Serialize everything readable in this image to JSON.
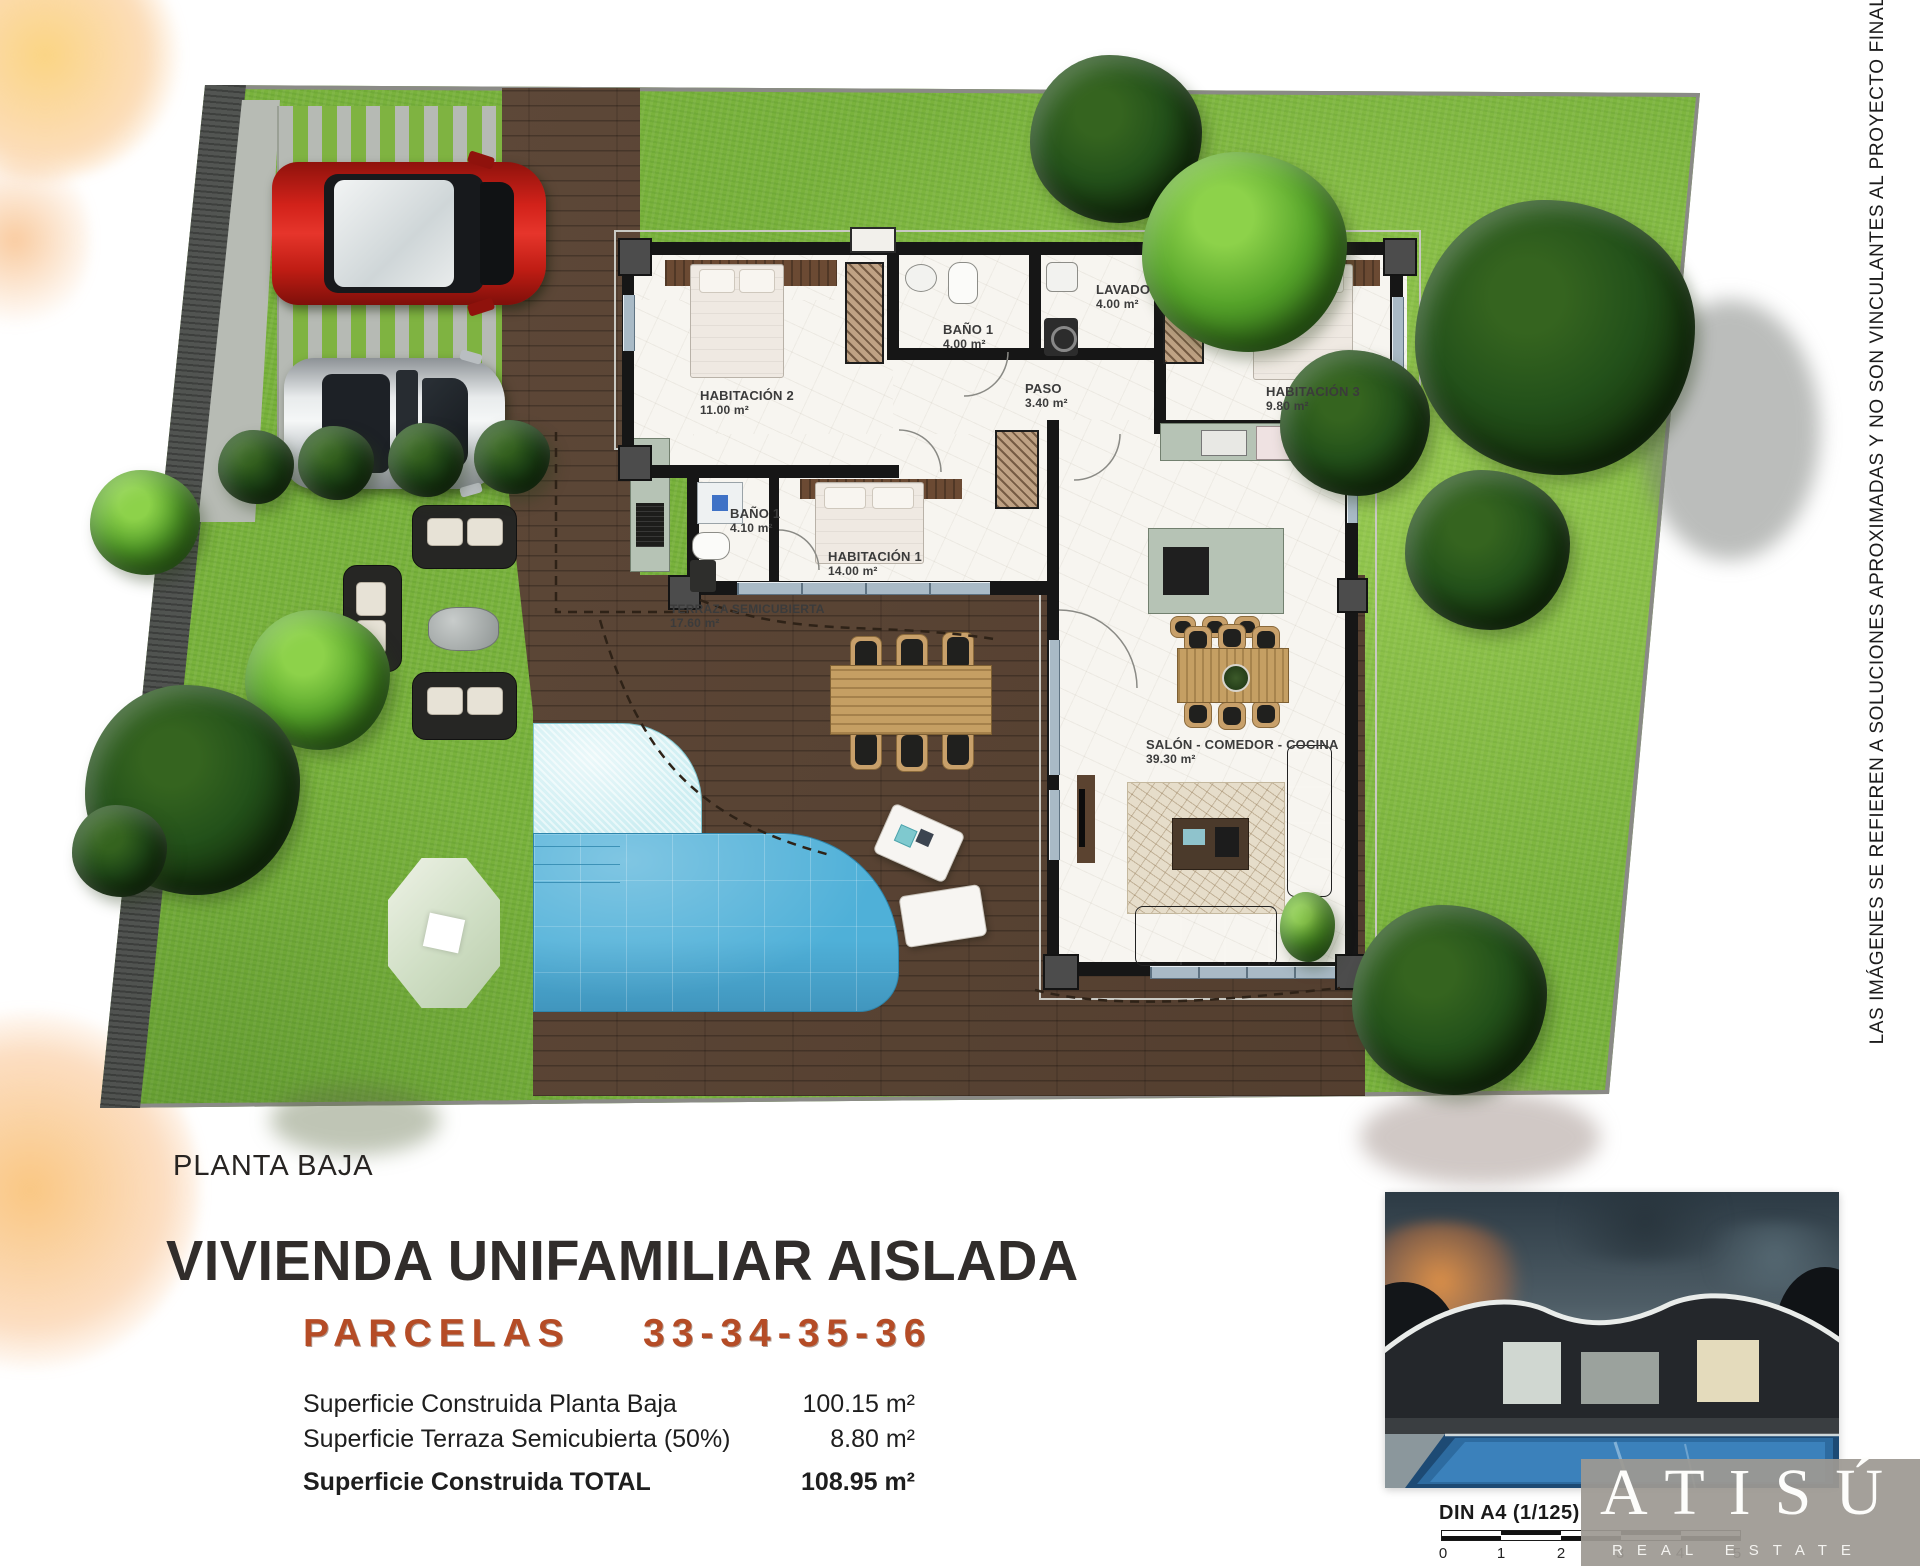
{
  "plan": {
    "floor_label": "PLANTA BAJA",
    "rooms": [
      {
        "name": "HABITACIÓN 2",
        "area": "11.00 m²"
      },
      {
        "name": "BAÑO 1",
        "area": "4.00 m²"
      },
      {
        "name": "LAVADO",
        "area": "4.00 m²"
      },
      {
        "name": "PASO",
        "area": "3.40 m²"
      },
      {
        "name": "HABITACIÓN 3",
        "area": "9.80 m²"
      },
      {
        "name": "BAÑO 1",
        "area": "4.10 m²"
      },
      {
        "name": "HABITACIÓN 1",
        "area": "14.00 m²"
      },
      {
        "name": "TERRAZA SEMICUBIERTA",
        "area": "17.60 m²"
      },
      {
        "name": "SALÓN - COMEDOR - COCINA",
        "area": "39.30 m²"
      }
    ],
    "disclaimer": "LAS IMÁGENES SE REFIEREN A SOLUCIONES APROXIMADAS Y NO SON VINCULANTES AL PROYECTO FINAL"
  },
  "title_block": {
    "title": "VIVIENDA UNIFAMILIAR AISLADA",
    "parcels_label": "PARCELAS",
    "parcels_numbers": "33-34-35-36",
    "areas": [
      {
        "label": "Superficie Construida Planta Baja",
        "value": "100.15 m²"
      },
      {
        "label": "Superficie Terraza Semicubierta (50%)",
        "value": "8.80 m²"
      },
      {
        "label": "Superficie Construida TOTAL",
        "value": "108.95 m²"
      }
    ]
  },
  "footer": {
    "sheet": "DIN A4 (1/125)",
    "scale_ticks": [
      "0",
      "1",
      "2",
      "3",
      "4",
      "5"
    ],
    "brand": "ATISÚ",
    "brand_sub": "REAL ESTATE"
  },
  "colors": {
    "grass": "#79b23c",
    "deck": "#57402f",
    "pool": "#4fb0d8",
    "accent_parcelas": "#b54c26",
    "wall": "#161616",
    "logo_box": "#9d9992"
  }
}
